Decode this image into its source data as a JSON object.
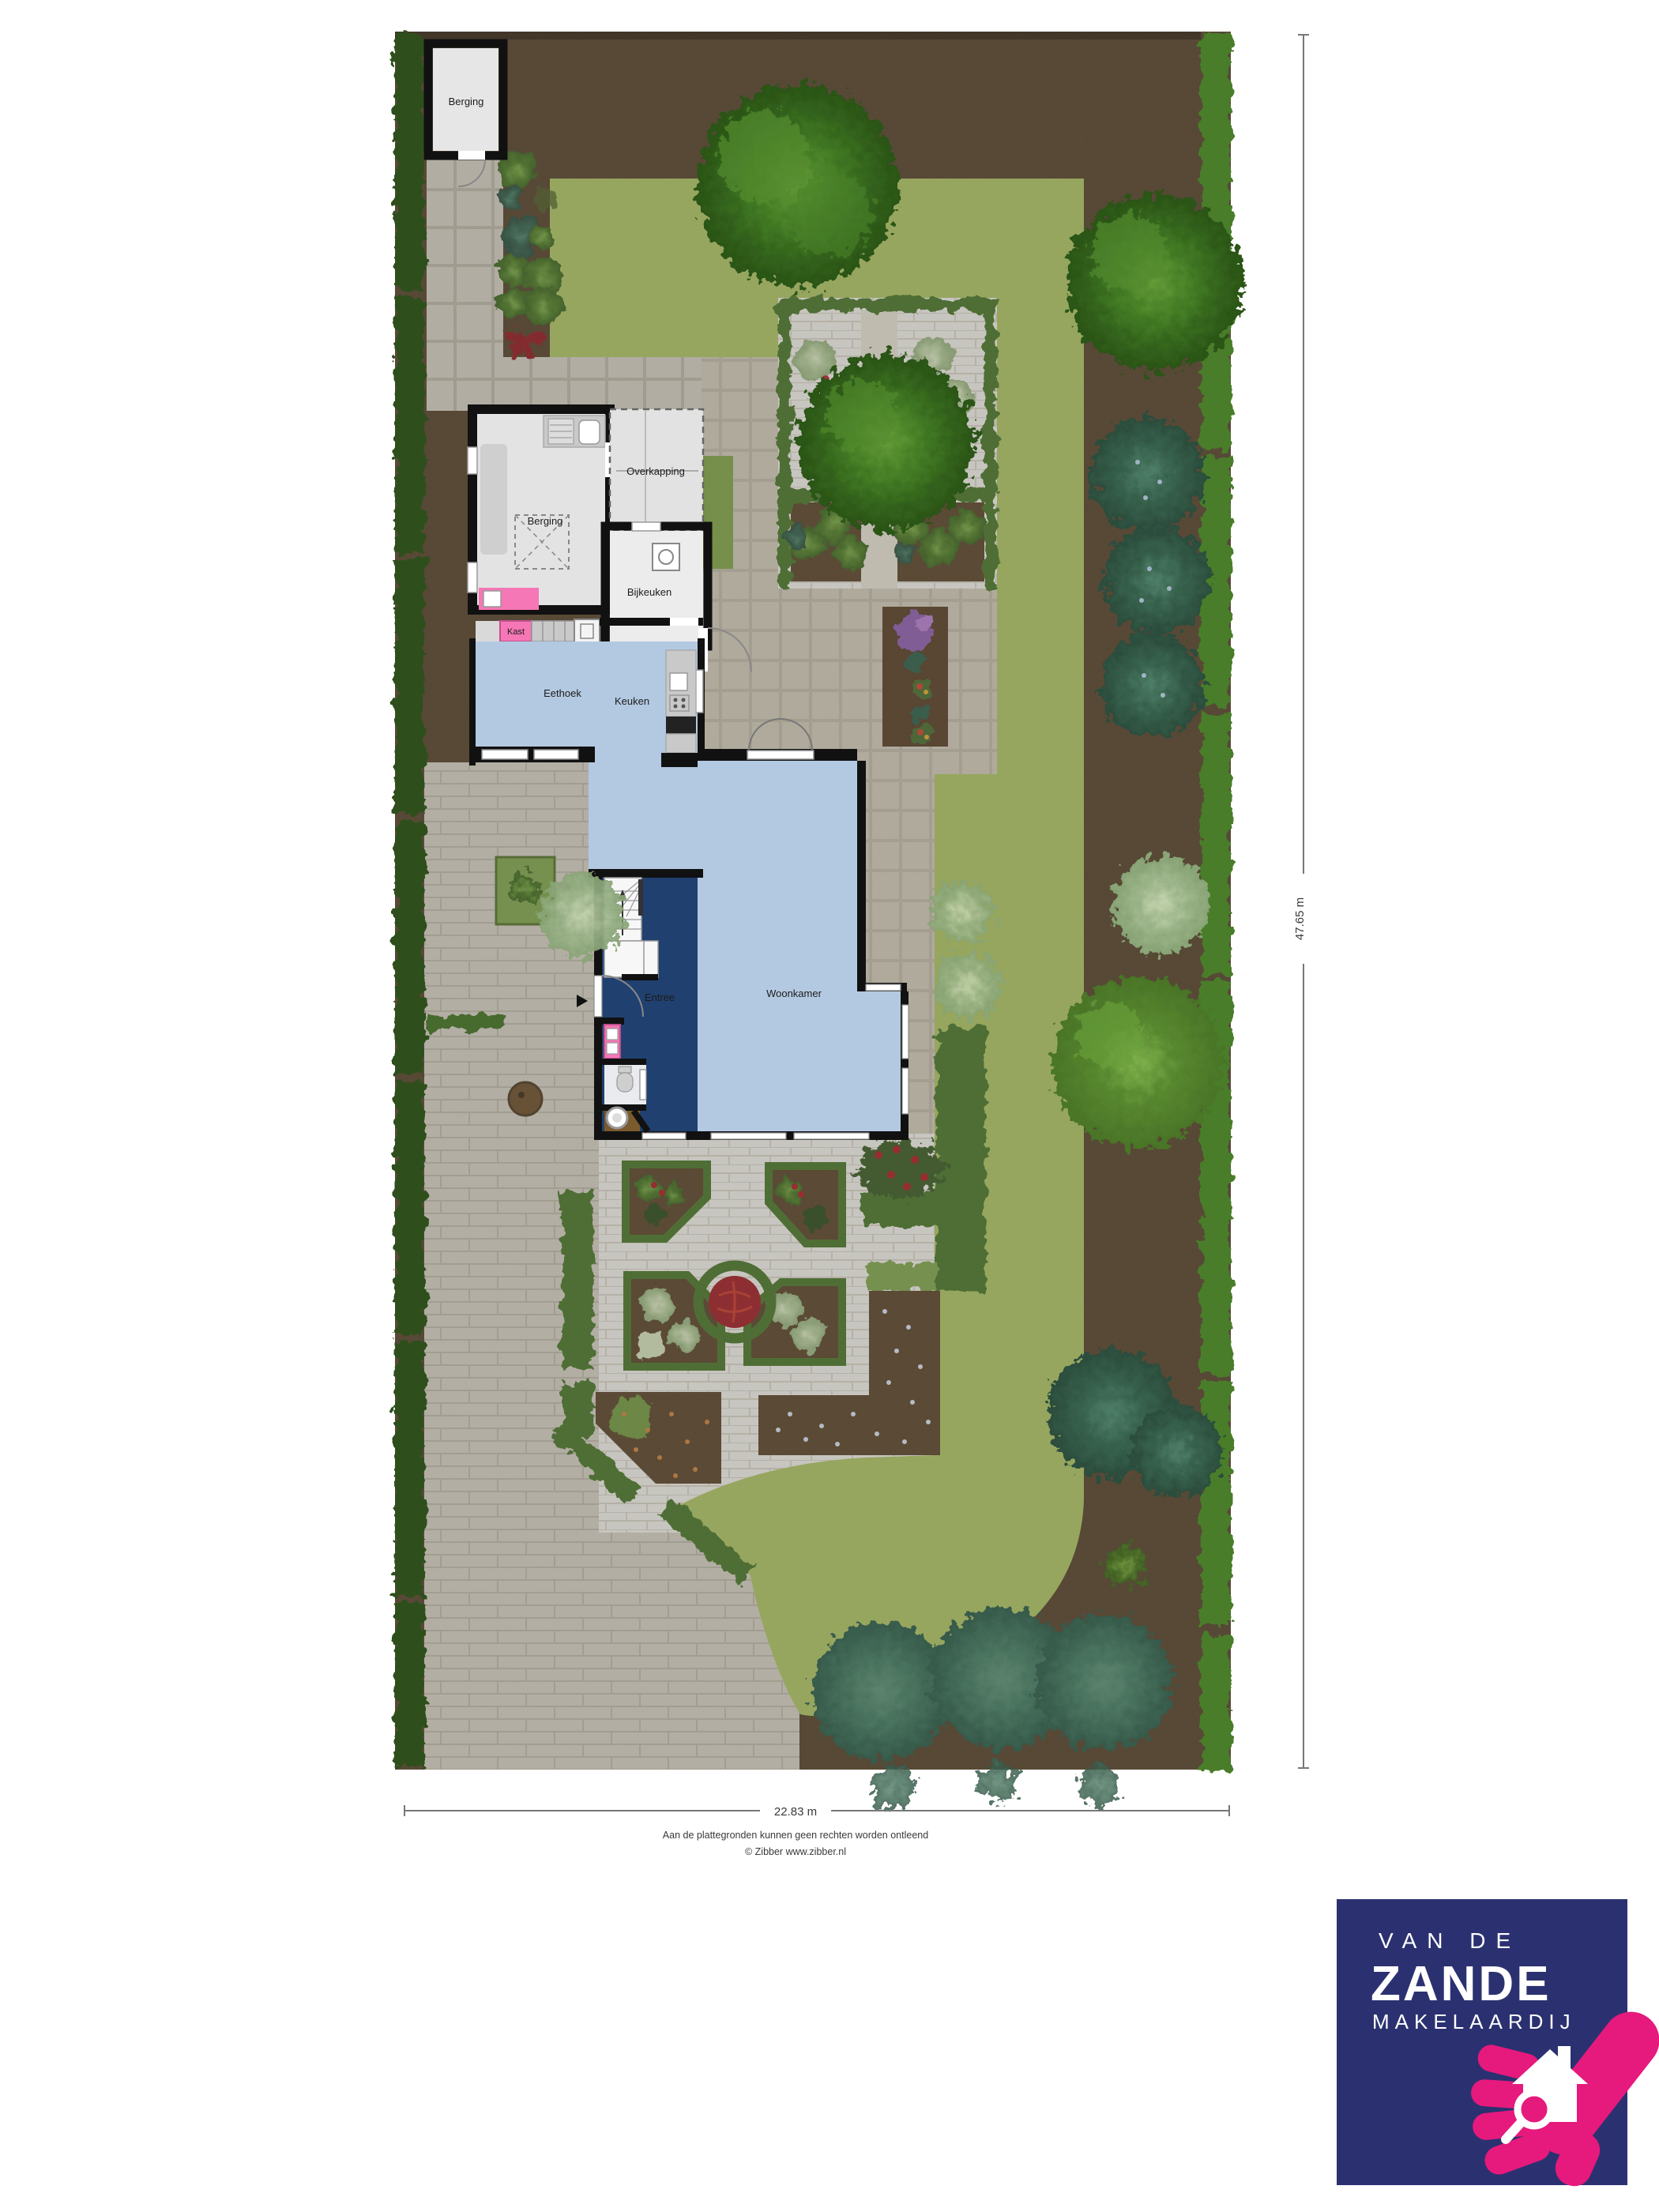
{
  "plan": {
    "rooms": {
      "shed": "Berging",
      "garage": "Berging",
      "overkapping": "Overkapping",
      "bijkeuken": "Bijkeuken",
      "kast": "Kast",
      "eethoek": "Eethoek",
      "keuken": "Keuken",
      "woonkamer": "Woonkamer",
      "entree": "Entree"
    },
    "dimensions": {
      "width": "22.83 m",
      "depth": "47.65 m"
    },
    "footer": {
      "disclaimer": "Aan de plattegronden kunnen geen rechten worden ontleend",
      "credit": "© Zibber www.zibber.nl"
    }
  },
  "logo": {
    "line1": "VAN DE",
    "line2": "ZANDE",
    "line3": "MAKELAARDIJ",
    "background_color": "#2b3170",
    "accent_color": "#e6197d"
  },
  "colors": {
    "soil": "#55422b",
    "lawn": "#a8bc60",
    "hedge_left": "#2e501b",
    "hedge_right": "#4a7d2b",
    "paving": "#cdc8bb",
    "terrace": "#c9c2b2",
    "garden_brick": "#e8e5de",
    "floor_light_blue": "#b3c9e2",
    "floor_dark_blue": "#20406f",
    "floor_gray": "#e4e4e4",
    "accent_pink": "#f577b5"
  }
}
